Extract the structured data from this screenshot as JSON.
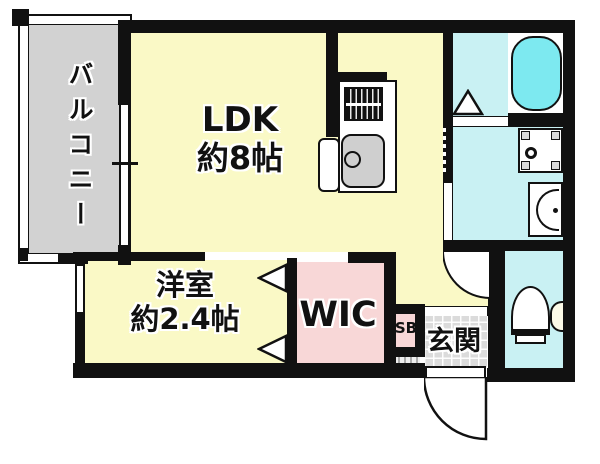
{
  "plan_title": "1K apartment floor plan",
  "rooms": {
    "balcony": {
      "label": "バルコニー"
    },
    "ldk": {
      "line1": "LDK",
      "line2": "約8帖"
    },
    "bedroom": {
      "line1": "洋室",
      "line2": "約2.4帖"
    },
    "wic": {
      "label": "WIC"
    },
    "sb": {
      "label": "SB"
    },
    "genkan": {
      "label": "玄関"
    }
  },
  "fixtures": {
    "stove": "gas-stove-icon",
    "sink": "kitchen-sink-icon",
    "bathtub": "bathtub-icon",
    "washer_pan": "washing-machine-pan-icon",
    "washbasin": "washbasin-icon",
    "toilet": "toilet-icon"
  },
  "colors": {
    "wall": "#111111",
    "room_yellow": "#FAF9C6",
    "closet_pink": "#F8D7D7",
    "wet_cyan": "#C9F1F3",
    "bathtub_cyan": "#7DE9F0",
    "balcony_gray": "#D2D2D2",
    "tile_gray": "#DBDBDB",
    "fixture_gray": "#CFCFCF"
  }
}
